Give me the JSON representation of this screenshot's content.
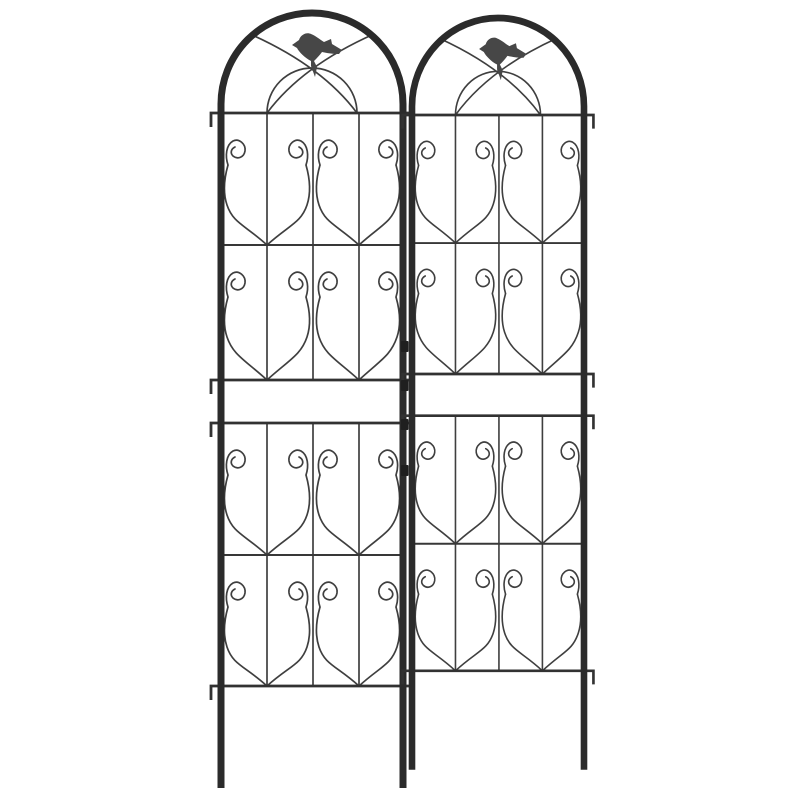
{
  "meta": {
    "alt_text": "Product photo of two black metal garden trellis panels standing side by side on a white background. Each panel has a round arched top with a perched bird silhouette, four rows of decorative scrollwork forming spiral-topped shield motifs, horizontal rails with downward end hooks, connector clips between the panels, and two ground stake legs."
  },
  "scene": {
    "background_color": "#ffffff"
  },
  "colors": {
    "frame": "#2b2b2b",
    "wire": "#3f3f3f",
    "rail": "#323232",
    "bar": "#383838",
    "bird": "#474747",
    "clip": "#1f1f1f"
  },
  "trellis": {
    "panel_count": 2,
    "panels": [
      {
        "name": "left"
      },
      {
        "name": "right"
      }
    ],
    "sections_per_panel": 4,
    "scrolls_per_section": 4,
    "shield_motifs_per_section": 2,
    "birds_count": 2,
    "bird_facing": "left",
    "arch_style": "round-top",
    "connector_clip_count": 4,
    "ground_stake_legs_per_panel": 2,
    "rail_hooks_per_panel": 8
  }
}
